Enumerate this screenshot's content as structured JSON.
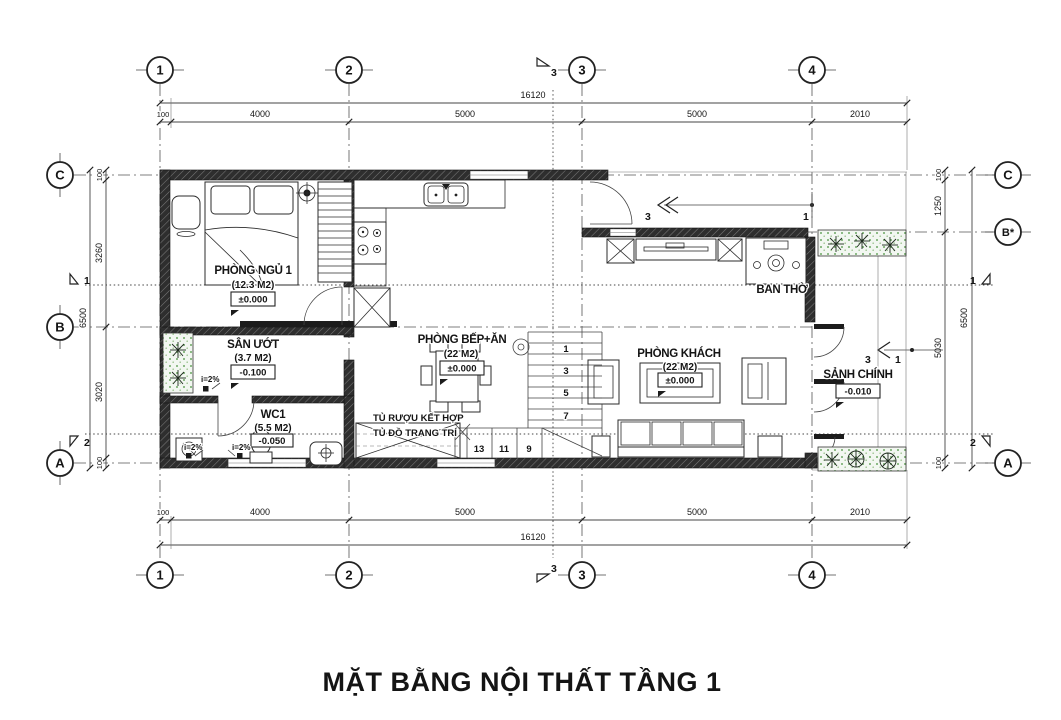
{
  "title": "MẶT BẰNG NỘI THẤT TẦNG 1",
  "grid": {
    "top": [
      "1",
      "2",
      "3",
      "4"
    ],
    "bottom": [
      "1",
      "2",
      "3",
      "4"
    ],
    "left": [
      "C",
      "B",
      "A"
    ],
    "right": [
      "C",
      "B*",
      "A"
    ]
  },
  "dims": {
    "top": {
      "overall": "16120",
      "segs": [
        "100",
        "4000",
        "5000",
        "5000",
        "2010"
      ]
    },
    "bottom": {
      "overall": "16120",
      "segs": [
        "100",
        "4000",
        "5000",
        "5000",
        "2010"
      ]
    },
    "left": {
      "overall": "6500",
      "segs": [
        "100",
        "3260",
        "3020",
        "100"
      ]
    },
    "right": {
      "overall": "6500",
      "segs": [
        "100",
        "1250",
        "5030",
        "100"
      ]
    }
  },
  "sections": {
    "cut1": "1",
    "cut2": "2",
    "cut3": "3",
    "ref3": "3",
    "ref1": "1"
  },
  "rooms": {
    "bedroom": {
      "name": "PHÒNG NGỦ 1",
      "area": "(12.3 M2)",
      "level": "±0.000"
    },
    "wet_area": {
      "name": "SÂN ƯỚT",
      "area": "(3.7 M2)",
      "level": "-0.100"
    },
    "wc": {
      "name": "WC1",
      "area": "(5.5 M2)",
      "level": "-0.050"
    },
    "kitchen": {
      "name": "PHÒNG BẾP+ĂN",
      "area": "(22 M2)",
      "level": "±0.000"
    },
    "living": {
      "name": "PHÒNG KHÁCH",
      "area": "(22 M2)",
      "level": "±0.000"
    },
    "hall": {
      "name": "SẢNH CHÍNH",
      "level": "-0.010"
    },
    "altar": {
      "name": "BAN THỜ"
    }
  },
  "notes": {
    "cabinet1": "TỦ RƯỢU KẾT HỢP",
    "cabinet2": "TỦ ĐỒ TRANG TRÍ",
    "slope": "i=2%"
  },
  "stairs": {
    "up": [
      "1",
      "3",
      "5",
      "7"
    ],
    "low": [
      "13",
      "11",
      "9"
    ]
  },
  "colors": {
    "wall": "#262626",
    "line": "#2b2b2b",
    "plant_green": "#6da863",
    "background": "#ffffff"
  }
}
